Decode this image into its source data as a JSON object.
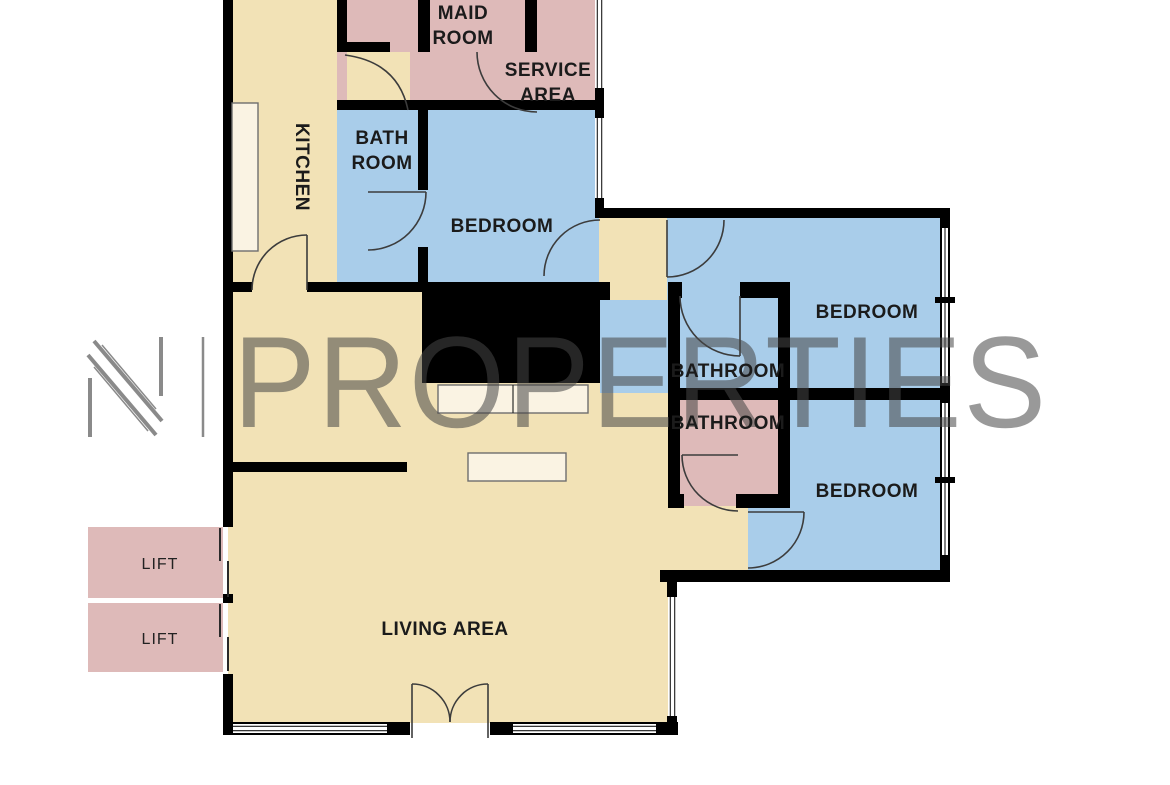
{
  "colors": {
    "tan": "#f2e2b6",
    "pink": "#debab9",
    "blue": "#a9cdea",
    "cream": "#faf3e3",
    "wall": "#000000",
    "door_stroke": "#3c3c3c",
    "label": "#1b1b1b",
    "watermark": "#464646",
    "logo_gray": "#8a8a8a"
  },
  "watermark": {
    "logo": "N",
    "separator": "|",
    "brand": "PROPERTIES"
  },
  "rooms": {
    "maid": {
      "line1": "MAID",
      "line2": "ROOM"
    },
    "service": {
      "line1": "SERVICE",
      "line2": "AREA"
    },
    "kitchen": {
      "label": "KITCHEN"
    },
    "bath_tl": {
      "line1": "BATH",
      "line2": "ROOM"
    },
    "bedroom_tl": {
      "label": "BEDROOM"
    },
    "bedroom_tr": {
      "label": "BEDROOM"
    },
    "bathroom_blue": {
      "label": "BATHROOM"
    },
    "bathroom_pink": {
      "label": "BATHROOM"
    },
    "bedroom_br": {
      "label": "BEDROOM"
    },
    "living": {
      "label": "LIVING AREA"
    },
    "lift1": {
      "label": "LIFT"
    },
    "lift2": {
      "label": "LIFT"
    }
  }
}
